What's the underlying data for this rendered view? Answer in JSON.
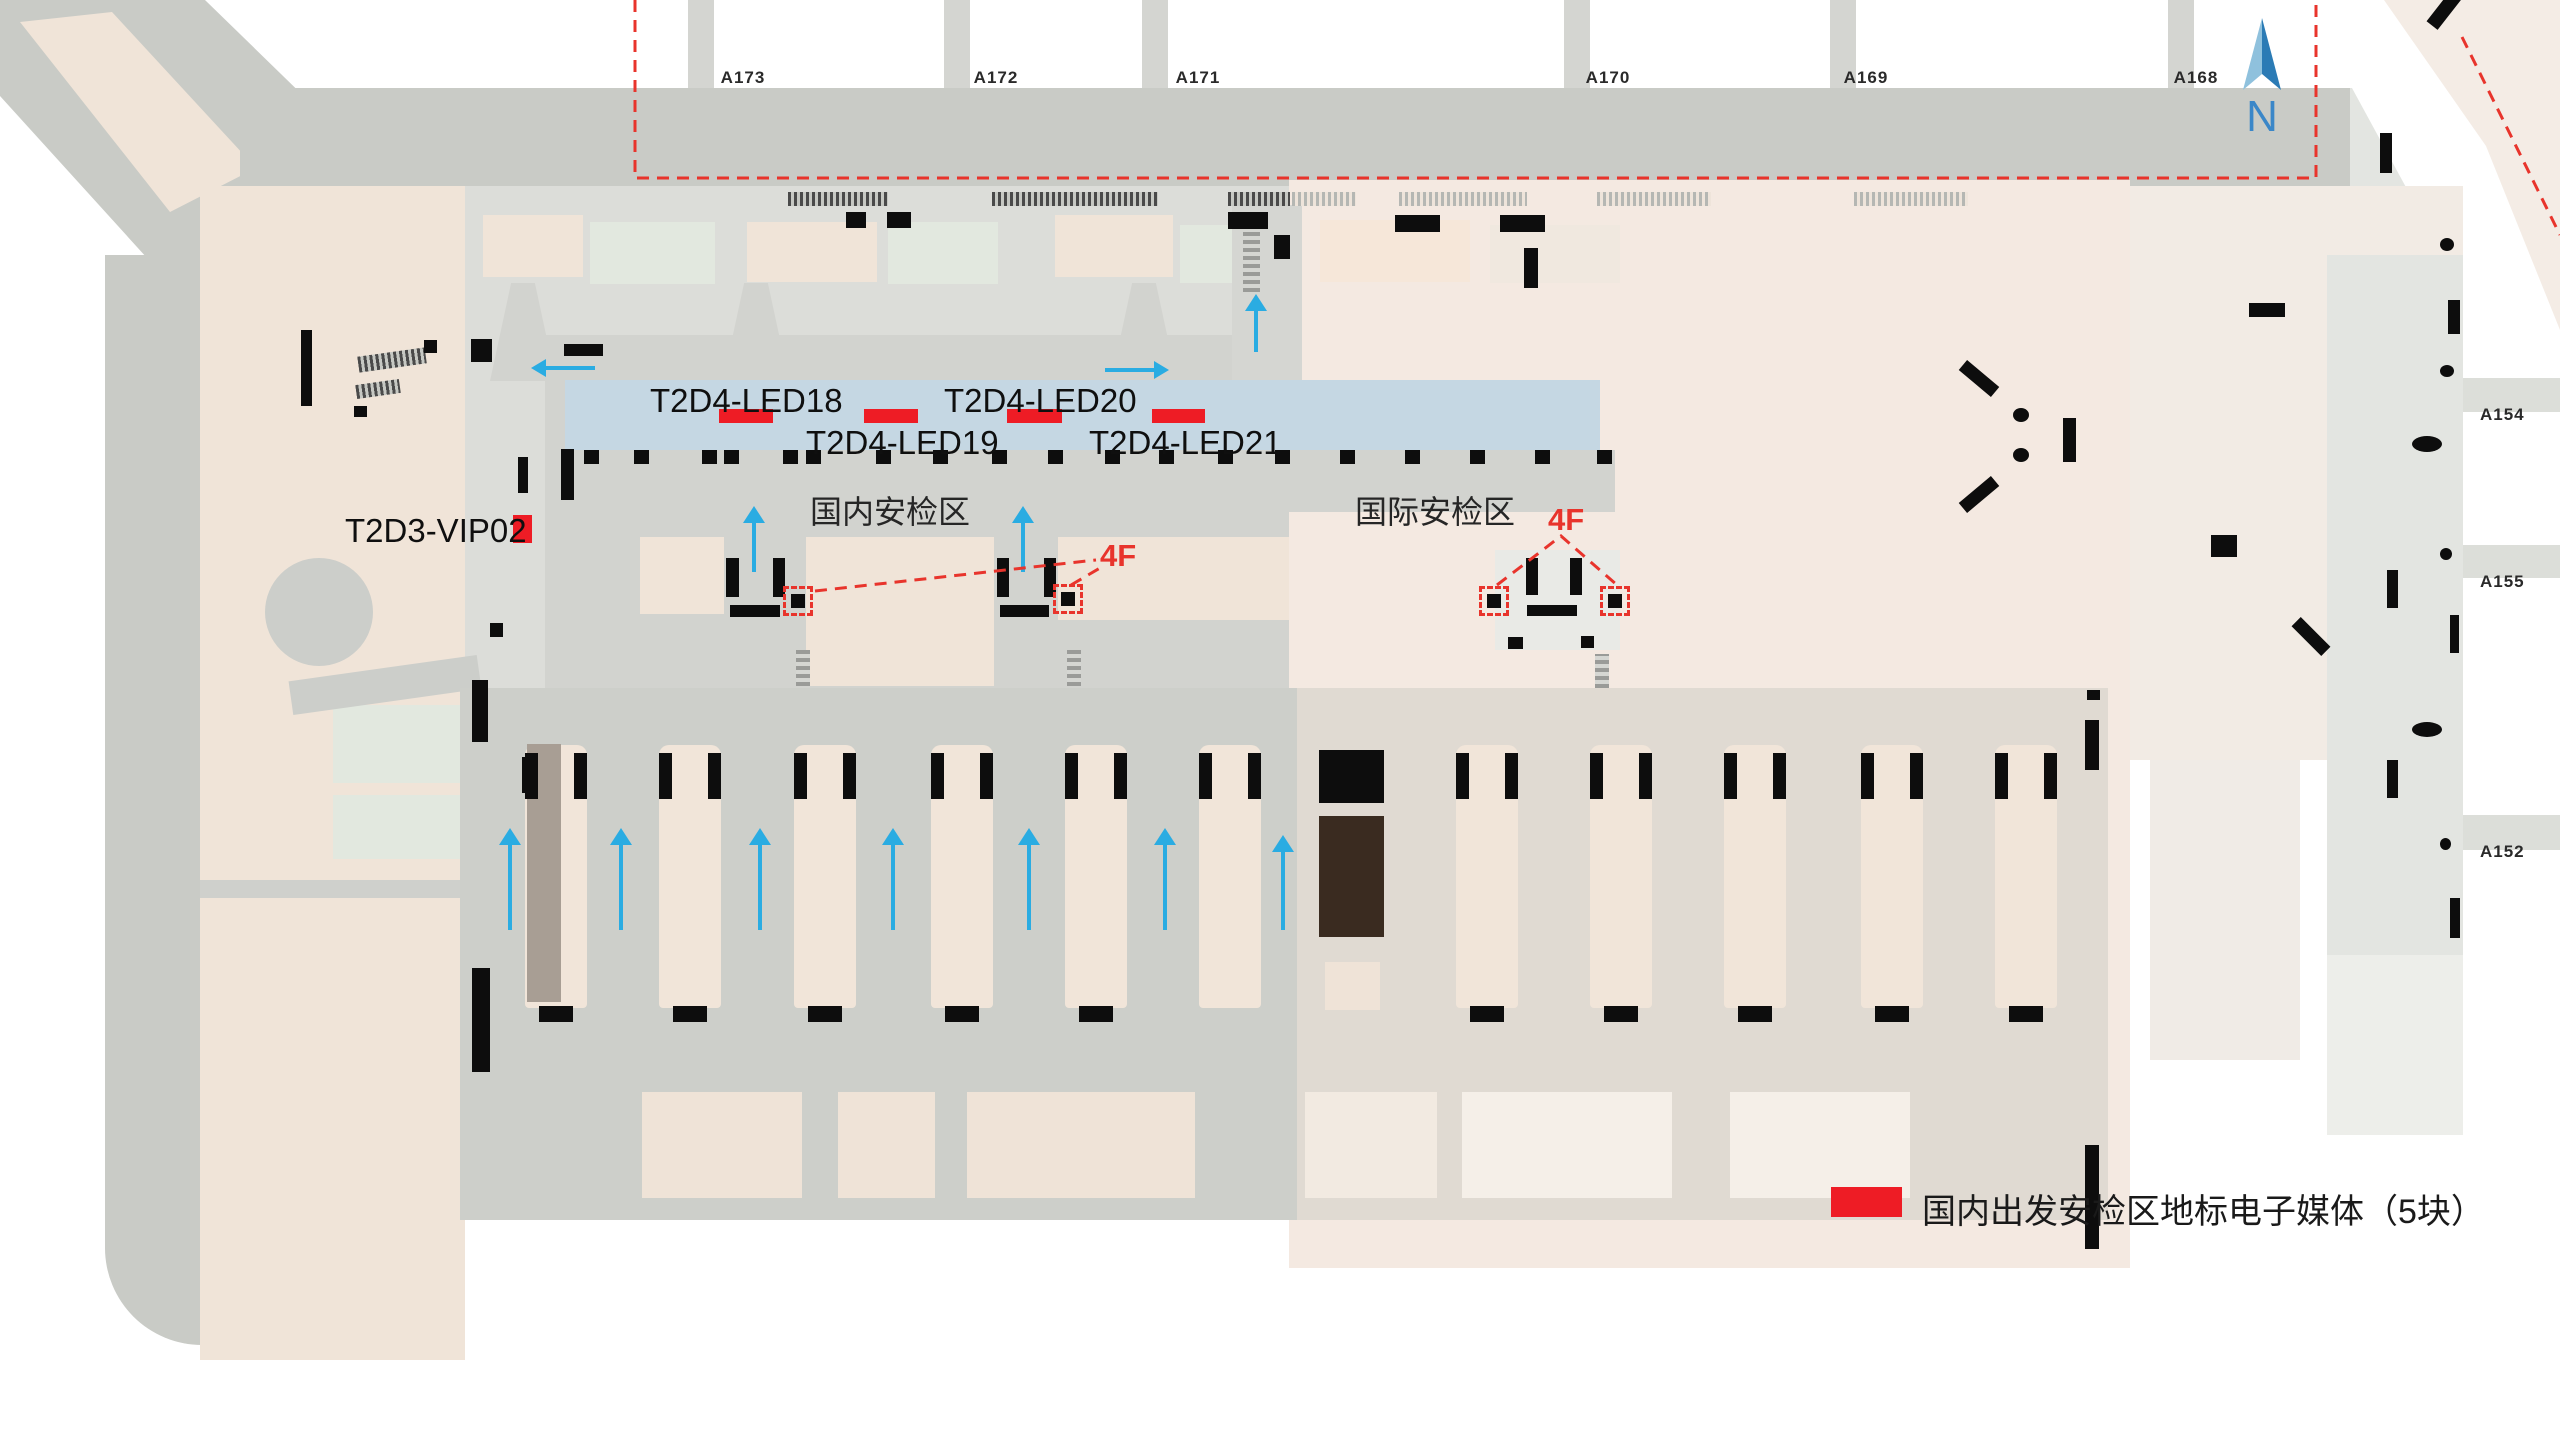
{
  "compass": {
    "label": "N"
  },
  "gates": {
    "top": [
      {
        "label": "A173"
      },
      {
        "label": "A172"
      },
      {
        "label": "A171"
      },
      {
        "label": "A170"
      },
      {
        "label": "A169"
      },
      {
        "label": "A168"
      }
    ],
    "right": [
      {
        "label": "A154"
      },
      {
        "label": "A155"
      },
      {
        "label": "A152"
      }
    ]
  },
  "media_markers": {
    "led": [
      {
        "id": "T2D4-LED18"
      },
      {
        "id": "T2D4-LED19"
      },
      {
        "id": "T2D4-LED20"
      },
      {
        "id": "T2D4-LED21"
      }
    ],
    "vip": {
      "id": "T2D3-VIP02"
    }
  },
  "security_zones": {
    "domestic": "国内安检区",
    "international": "国际安检区"
  },
  "floor_callouts": {
    "domestic": "4F",
    "international": "4F"
  },
  "legend": {
    "text": "国内出发安检区地标电子媒体（5块）"
  },
  "colors": {
    "media_red": "#ee1c25",
    "callout_red": "#e8342c",
    "arrow_blue": "#2aace2",
    "band_blue": "#c5d7e3",
    "compass_blue": "#3b87c8"
  }
}
